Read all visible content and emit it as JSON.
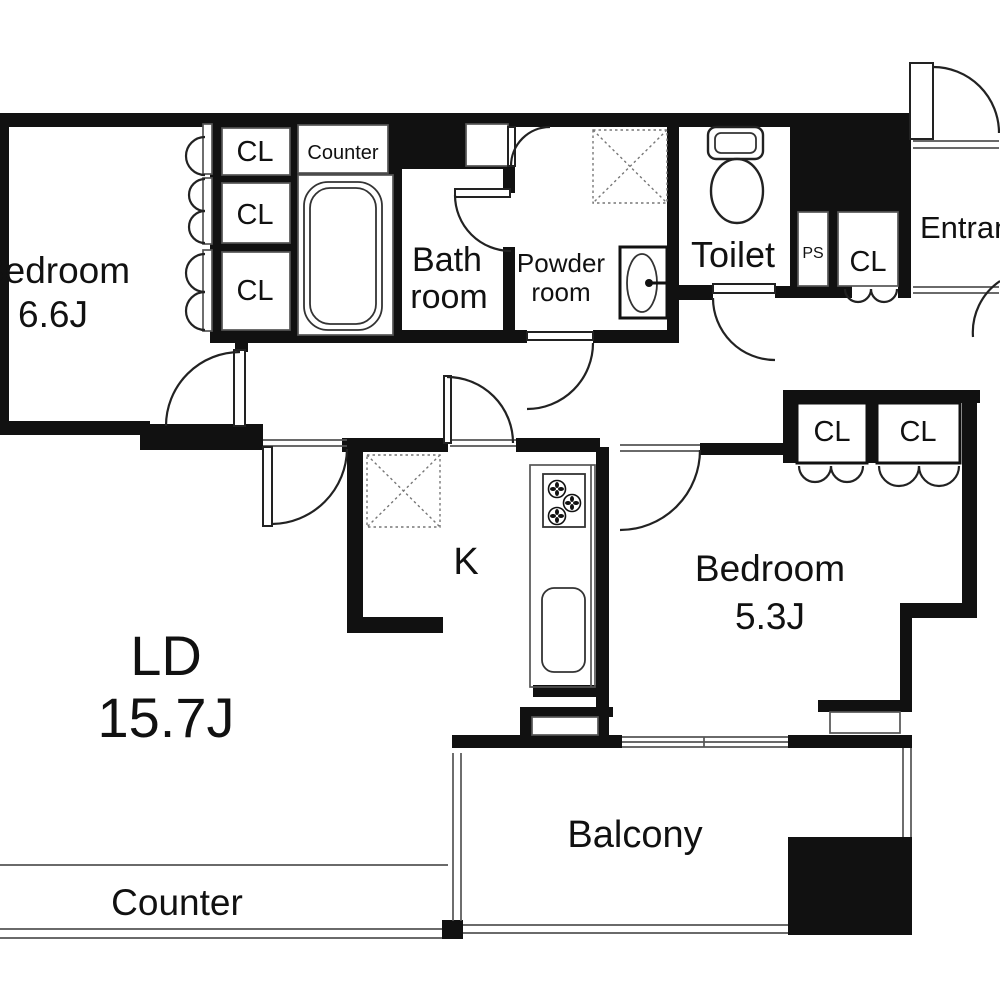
{
  "floor_plan": {
    "rooms": {
      "bedroom_main": {
        "label": "Bedroom",
        "size": "6.6J"
      },
      "bedroom_second": {
        "label": "Bedroom",
        "size": "5.3J"
      },
      "living_dining": {
        "label": "LD",
        "size": "15.7J"
      },
      "kitchen": {
        "label": "K"
      },
      "bathroom": {
        "label_line1": "Bath",
        "label_line2": "room"
      },
      "powder_room": {
        "label_line1": "Powder",
        "label_line2": "room"
      },
      "toilet": {
        "label": "Toilet"
      },
      "entrance": {
        "label": "Entrance"
      },
      "balcony": {
        "label": "Balcony"
      },
      "pipe_space": {
        "label": "PS"
      }
    },
    "closet_label": "CL",
    "bathroom_counter_label": "Counter",
    "living_counter_label": "Counter",
    "colors": {
      "wall": "#111111",
      "background": "#ffffff",
      "thin_line": "#555555"
    }
  }
}
